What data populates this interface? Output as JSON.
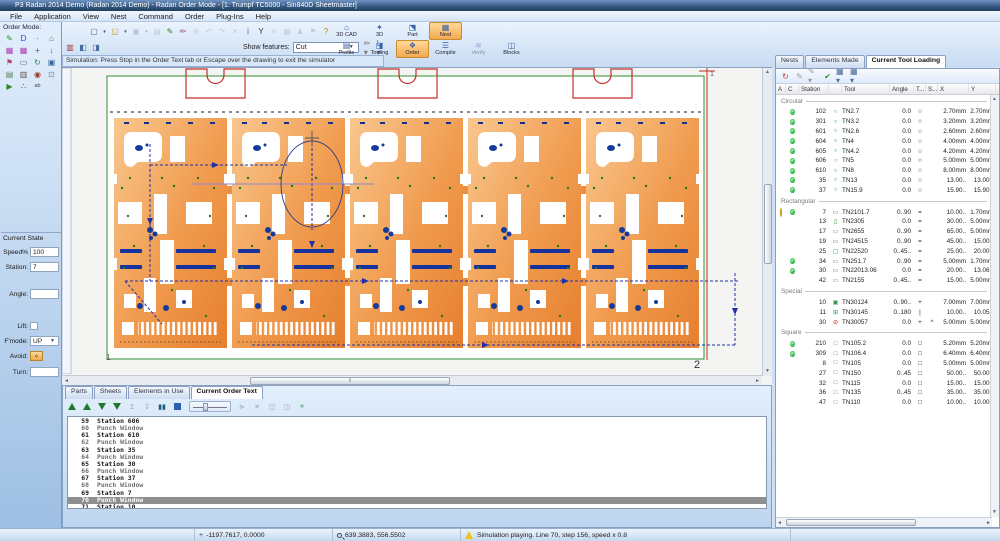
{
  "window": {
    "title": "P3 Radan 2014 Demo (Radan 2014 Demo) - Radan Order Mode - [1: Trumpf TC5000 - Sin840D Sheetmaster]"
  },
  "menus": [
    "File",
    "Application",
    "View",
    "Nest",
    "Command",
    "Order",
    "Plug-Ins",
    "Help"
  ],
  "order_mode_label": "Order Mode:",
  "sidebar_icons": [
    {
      "name": "draw-icon",
      "ch": "✎",
      "c": "#1f8f1f"
    },
    {
      "name": "part-icon",
      "ch": "D",
      "c": "#2050c0"
    },
    {
      "name": "dot-icon",
      "ch": "·",
      "c": "#555"
    },
    {
      "name": "house-icon",
      "ch": "⌂",
      "c": "#8a6a3a"
    },
    {
      "name": "pattern1-icon",
      "ch": "▦",
      "c": "#b03ab0"
    },
    {
      "name": "pattern2-icon",
      "ch": "▦",
      "c": "#b03ab0"
    },
    {
      "name": "move-icon",
      "ch": "+",
      "c": "#2050c0"
    },
    {
      "name": "arrow-down-icon",
      "ch": "↓",
      "c": "#b03ab0"
    },
    {
      "name": "flag-icon",
      "ch": "⚑",
      "c": "#b04060"
    },
    {
      "name": "rect-tool-icon",
      "ch": "▭",
      "c": "#556"
    },
    {
      "name": "rotate-icon",
      "ch": "↻",
      "c": "#2a8a4a"
    },
    {
      "name": "copy-icon",
      "ch": "▣",
      "c": "#35679a"
    },
    {
      "name": "sheet-icon",
      "ch": "▤",
      "c": "#58865a"
    },
    {
      "name": "film-icon",
      "ch": "▥",
      "c": "#665544"
    },
    {
      "name": "target-icon",
      "ch": "◉",
      "c": "#953a2a"
    },
    {
      "name": "disk-icon",
      "ch": "⊡",
      "c": "#789"
    },
    {
      "name": "go-icon",
      "ch": "▶",
      "c": "#2a8a2a"
    },
    {
      "name": "dots-icon",
      "ch": "∴",
      "c": "#444"
    },
    {
      "name": "abc-icon",
      "ch": "ᵃᵇ",
      "c": "#444"
    }
  ],
  "toolbar1_icons": [
    {
      "name": "new-icon",
      "ch": "▢",
      "c": "#4a6a9a"
    },
    {
      "name": "new-dropdown",
      "ch": "▾",
      "c": "#446",
      "drop": true
    },
    {
      "name": "open-icon",
      "ch": "◱",
      "c": "#c79a2a"
    },
    {
      "name": "open-dropdown",
      "ch": "▾",
      "c": "#446",
      "drop": true
    },
    {
      "name": "save-icon",
      "ch": "▣",
      "c": "#6a88b8",
      "dis": true
    },
    {
      "name": "save-dropdown",
      "ch": "▾",
      "c": "#446",
      "drop": true,
      "dis": true
    },
    {
      "name": "print-icon",
      "ch": "▤",
      "c": "#8a95a5",
      "dis": true
    },
    {
      "name": "edit-icon",
      "ch": "✎",
      "c": "#2a7a2a"
    },
    {
      "name": "pen-icon",
      "ch": "✏",
      "c": "#a04a7a"
    },
    {
      "name": "node-icon",
      "ch": "⊕",
      "c": "#9aa",
      "dis": true
    },
    {
      "name": "undo-icon",
      "ch": "↶",
      "c": "#99a",
      "dis": true
    },
    {
      "name": "redo-icon",
      "ch": "↷",
      "c": "#99a",
      "dis": true
    },
    {
      "name": "delete-icon",
      "ch": "✕",
      "c": "#99a",
      "dis": true
    },
    {
      "name": "info-icon",
      "ch": "i",
      "c": "#2a64c8"
    },
    {
      "name": "filter-icon",
      "ch": "Y",
      "c": "#333"
    },
    {
      "name": "list-icon",
      "ch": "≡",
      "c": "#99a",
      "dis": true
    },
    {
      "name": "grid-icon",
      "ch": "▦",
      "c": "#99a",
      "dis": true
    },
    {
      "name": "user-icon",
      "ch": "♟",
      "c": "#99a",
      "dis": true
    },
    {
      "name": "flag2-icon",
      "ch": "⚑",
      "c": "#99a",
      "dis": true
    },
    {
      "name": "help-icon",
      "ch": "?",
      "c": "#b8860b"
    }
  ],
  "toolbar2_icons": [
    {
      "name": "simulate-icon",
      "ch": "▥",
      "c": "#a03a3a"
    },
    {
      "name": "window-left-icon",
      "ch": "◧",
      "c": "#4a6a9a"
    },
    {
      "name": "window-right-icon",
      "ch": "◨",
      "c": "#4a6a9a"
    }
  ],
  "show_features": {
    "label": "Show features:",
    "value": "Cut"
  },
  "toolbar2_right": [
    {
      "name": "pen-dropdown",
      "ch": "✏",
      "c": "#777",
      "drop": true
    },
    {
      "name": "layer-dropdown",
      "ch": "L",
      "c": "#4a6a9a",
      "drop": true
    }
  ],
  "hint": "Simulation: Press Stop in the Order Text tab or Escape over the drawing to exit the simulator",
  "modules": {
    "row1": [
      {
        "label": "3D CAD",
        "icon": "⌂",
        "name": "module-3d-cad"
      },
      {
        "label": "3D",
        "icon": "✦",
        "name": "module-3d"
      },
      {
        "label": "Part",
        "icon": "⬔",
        "name": "module-part"
      },
      {
        "label": "Nest",
        "icon": "▦",
        "name": "module-nest",
        "active": true
      }
    ],
    "row2": [
      {
        "label": "Profile",
        "icon": "▤",
        "name": "module-profile"
      },
      {
        "label": "Tooling",
        "icon": "◨",
        "name": "module-tooling"
      },
      {
        "label": "Order",
        "icon": "❖",
        "name": "module-order",
        "active": true
      },
      {
        "label": "Compile",
        "icon": "☰",
        "name": "module-compile"
      },
      {
        "label": "Verify",
        "icon": "≋",
        "name": "module-verify",
        "dis": true
      },
      {
        "label": "Blocks",
        "icon": "◫",
        "name": "module-blocks"
      }
    ]
  },
  "current_state": {
    "title": "Current State",
    "speed_label": "Speed%",
    "speed": "100",
    "station_label": "Station:",
    "station": "7",
    "angle_label": "Angle:",
    "angle": "",
    "lift_label": "Lift:",
    "fmode_label": "F'mode:",
    "fmode": "UP",
    "avoid_label": "Avoid:",
    "turn_label": "Turn:",
    "turn": ""
  },
  "canvas": {
    "label_left": "1",
    "label_right": "2",
    "label_top_right": "1"
  },
  "right_panel": {
    "tabs": [
      {
        "label": "Nests"
      },
      {
        "label": "Elements Made"
      },
      {
        "label": "Current Tool Loading",
        "active": true
      }
    ],
    "columns": [
      "A",
      "C",
      "Station",
      "Tool",
      "Angle",
      "T...",
      "S...",
      "X",
      "Y"
    ],
    "groups": [
      {
        "name": "Circular",
        "rows": [
          {
            "a": "",
            "c": "check",
            "st": "102",
            "g": "○",
            "gc": "#2f9a3f",
            "tool": "TN2.7",
            "ang": "0.0",
            "t": "○",
            "s": "",
            "x": "2.70mm",
            "y": "2.70mm"
          },
          {
            "a": "",
            "c": "check",
            "st": "301",
            "g": "○",
            "gc": "#2f9a3f",
            "tool": "TN3.2",
            "ang": "0.0",
            "t": "○",
            "s": "",
            "x": "3.20mm",
            "y": "3.20mm"
          },
          {
            "a": "",
            "c": "check",
            "st": "601",
            "g": "○",
            "gc": "#2f9a3f",
            "tool": "TN2.6",
            "ang": "0.0",
            "t": "○",
            "s": "",
            "x": "2.60mm",
            "y": "2.60mm"
          },
          {
            "a": "",
            "c": "check",
            "st": "604",
            "g": "○",
            "gc": "#2f9a3f",
            "tool": "TN4",
            "ang": "0.0",
            "t": "○",
            "s": "",
            "x": "4.00mm",
            "y": "4.00mm"
          },
          {
            "a": "",
            "c": "check",
            "st": "605",
            "g": "○",
            "gc": "#2f9a3f",
            "tool": "TN4.2",
            "ang": "0.0",
            "t": "○",
            "s": "",
            "x": "4.20mm",
            "y": "4.20mm"
          },
          {
            "a": "",
            "c": "check",
            "st": "606",
            "g": "○",
            "gc": "#2f9a3f",
            "tool": "TN5",
            "ang": "0.0",
            "t": "○",
            "s": "",
            "x": "5.00mm",
            "y": "5.00mm"
          },
          {
            "a": "",
            "c": "check",
            "st": "610",
            "g": "○",
            "gc": "#2f9a3f",
            "tool": "TN8",
            "ang": "0.0",
            "t": "○",
            "s": "",
            "x": "8.00mm",
            "y": "8.00mm"
          },
          {
            "a": "",
            "c": "check",
            "st": "35",
            "g": "○",
            "gc": "#2f9a3f",
            "tool": "TN13",
            "ang": "0.0",
            "t": "○",
            "s": "",
            "x": "13.00..",
            "y": "13.00.."
          },
          {
            "a": "",
            "c": "check",
            "st": "37",
            "g": "○",
            "gc": "#2f9a3f",
            "tool": "TN15.9",
            "ang": "0.0",
            "t": "○",
            "s": "",
            "x": "15.90..",
            "y": "15.90.."
          }
        ]
      },
      {
        "name": "Rectangular",
        "rows": [
          {
            "a": "bulb",
            "c": "check",
            "st": "7",
            "g": "▭",
            "gc": "#2f9a3f",
            "tool": "TN2101.7",
            "ang": "0..90",
            "t": "=",
            "s": "",
            "x": "10.00..",
            "y": "1.70mm"
          },
          {
            "a": "",
            "c": "",
            "st": "13",
            "g": "▯",
            "gc": "#2f9a3f",
            "tool": "TN2305",
            "ang": "0.0",
            "t": "=",
            "s": "",
            "x": "30.00..",
            "y": "5.00mm"
          },
          {
            "a": "",
            "c": "",
            "st": "17",
            "g": "▭",
            "gc": "#2f9a3f",
            "tool": "TN2655",
            "ang": "0..90",
            "t": "=",
            "s": "",
            "x": "65.00..",
            "y": "5.00mm"
          },
          {
            "a": "",
            "c": "",
            "st": "19",
            "g": "▭",
            "gc": "#2f9a3f",
            "tool": "TN24515",
            "ang": "0..90",
            "t": "=",
            "s": "",
            "x": "45.00..",
            "y": "15.00.."
          },
          {
            "a": "",
            "c": "",
            "st": "25",
            "g": "▢",
            "gc": "#2f9a3f",
            "tool": "TN22520",
            "ang": "0..45..",
            "t": "=",
            "s": "",
            "x": "25.00..",
            "y": "20.00.."
          },
          {
            "a": "",
            "c": "check",
            "st": "34",
            "g": "▭",
            "gc": "#2f9a3f",
            "tool": "TN251.7",
            "ang": "0..90",
            "t": "=",
            "s": "",
            "x": "5.00mm",
            "y": "1.70mm"
          },
          {
            "a": "",
            "c": "check",
            "st": "30",
            "g": "▭",
            "gc": "#2f9a3f",
            "tool": "TN22013.06",
            "ang": "0.0",
            "t": "=",
            "s": "",
            "x": "20.00..",
            "y": "13.06.."
          },
          {
            "a": "",
            "c": "",
            "st": "42",
            "g": "▭",
            "gc": "#2f9a3f",
            "tool": "TN2155",
            "ang": "0..45..",
            "t": "=",
            "s": "",
            "x": "15.00..",
            "y": "5.00mm"
          }
        ]
      },
      {
        "name": "Special",
        "rows": [
          {
            "a": "",
            "c": "",
            "st": "10",
            "g": "▣",
            "gc": "#2f9a3f",
            "tool": "TN30124",
            "ang": "0..90..",
            "t": "+",
            "s": "",
            "x": "7.00mm",
            "y": "7.00mm"
          },
          {
            "a": "",
            "c": "",
            "st": "11",
            "g": "⊞",
            "gc": "#2f9a3f",
            "tool": "TN30145",
            "ang": "0..180",
            "t": "|",
            "s": "",
            "x": "10.00..",
            "y": "10.05.."
          },
          {
            "a": "",
            "c": "",
            "st": "30",
            "g": "⊘",
            "gc": "#cc2020",
            "tool": "TN30057",
            "ang": "0.0",
            "t": "+",
            "s": "^",
            "x": "5.00mm",
            "y": "5.00mm"
          }
        ]
      },
      {
        "name": "Square",
        "rows": [
          {
            "a": "",
            "c": "check",
            "st": "210",
            "g": "□",
            "gc": "#2f9a3f",
            "tool": "TN105.2",
            "ang": "0.0",
            "t": "□",
            "s": "",
            "x": "5.20mm",
            "y": "5.20mm"
          },
          {
            "a": "",
            "c": "check",
            "st": "309",
            "g": "□",
            "gc": "#2f9a3f",
            "tool": "TN106.4",
            "ang": "0.0",
            "t": "□",
            "s": "",
            "x": "6.40mm",
            "y": "6.40mm"
          },
          {
            "a": "",
            "c": "",
            "st": "8",
            "g": "□",
            "gc": "#2f9a3f",
            "tool": "TN105",
            "ang": "0.0",
            "t": "□",
            "s": "",
            "x": "5.00mm",
            "y": "5.00mm"
          },
          {
            "a": "",
            "c": "",
            "st": "27",
            "g": "□",
            "gc": "#2f9a3f",
            "tool": "TN150",
            "ang": "0..45",
            "t": "□",
            "s": "",
            "x": "50.00..",
            "y": "50.00.."
          },
          {
            "a": "",
            "c": "",
            "st": "32",
            "g": "□",
            "gc": "#2f9a3f",
            "tool": "TN115",
            "ang": "0.0",
            "t": "□",
            "s": "",
            "x": "15.00..",
            "y": "15.00.."
          },
          {
            "a": "",
            "c": "",
            "st": "36",
            "g": "□",
            "gc": "#2f9a3f",
            "tool": "TN135",
            "ang": "0..45",
            "t": "□",
            "s": "",
            "x": "35.00..",
            "y": "35.00.."
          },
          {
            "a": "",
            "c": "",
            "st": "47",
            "g": "□",
            "gc": "#2f9a3f",
            "tool": "TN110",
            "ang": "0.0",
            "t": "□",
            "s": "",
            "x": "10.00..",
            "y": "10.00.."
          }
        ]
      }
    ],
    "toolbar_icons": [
      {
        "name": "refresh-icon",
        "ch": "↻",
        "c": "#c04040"
      },
      {
        "name": "edit-tool-icon",
        "ch": "✎",
        "c": "#9a9a9a"
      },
      {
        "name": "edit-multi-icon",
        "ch": "✎",
        "c": "#9a9a9a",
        "drop": true
      },
      {
        "name": "apply-check-icon",
        "ch": "✔",
        "c": "#2a9a2a"
      },
      {
        "name": "view-grid1-dropdown",
        "ch": "▦",
        "c": "#4a6a9a",
        "drop": true
      },
      {
        "name": "view-grid2-dropdown",
        "ch": "▦",
        "c": "#4a6a9a",
        "drop": true
      }
    ]
  },
  "bottom_panel": {
    "tabs": [
      {
        "label": "Parts"
      },
      {
        "label": "Sheets"
      },
      {
        "label": "Elements in Use"
      },
      {
        "label": "Current Order Text",
        "active": true
      }
    ],
    "toolbar": [
      {
        "name": "run-to-start-button",
        "kind": "tri-up-bar"
      },
      {
        "name": "play-back-button",
        "kind": "tri-up"
      },
      {
        "name": "play-forward-button",
        "kind": "tri-down"
      },
      {
        "name": "run-to-end-button",
        "kind": "tri-down-bar"
      },
      {
        "name": "step-back-button",
        "kind": "txt",
        "ch": "↥",
        "c": "#9aa5b5"
      },
      {
        "name": "step-forward-button",
        "kind": "txt",
        "ch": "↧",
        "c": "#9aa5b5"
      },
      {
        "name": "pause-button",
        "kind": "txt",
        "ch": "▮▮",
        "c": "#1c5f74"
      },
      {
        "name": "stop-button",
        "kind": "stop"
      },
      {
        "name": "speed-slider",
        "kind": "slider"
      },
      {
        "name": "jump-button",
        "kind": "txt",
        "ch": "⊳",
        "c": "#9aa5b5"
      },
      {
        "name": "cut-line-button",
        "kind": "txt",
        "ch": "✕",
        "c": "#9aa5b5"
      },
      {
        "name": "block1-button",
        "kind": "txt",
        "ch": "◫",
        "c": "#9aa5b5"
      },
      {
        "name": "block2-button",
        "kind": "txt",
        "ch": "◫",
        "c": "#9aa5b5"
      },
      {
        "name": "more-button",
        "kind": "txt",
        "ch": "»",
        "c": "#1c7a2d"
      }
    ],
    "lines": [
      {
        "n": "59",
        "text": "Station 606",
        "kind": "station"
      },
      {
        "n": "60",
        "text": "Punch Window",
        "kind": "punch"
      },
      {
        "n": "61",
        "text": "Station 610",
        "kind": "station"
      },
      {
        "n": "62",
        "text": "Punch Window",
        "kind": "punch"
      },
      {
        "n": "63",
        "text": "Station 35",
        "kind": "station"
      },
      {
        "n": "64",
        "text": "Punch Window",
        "kind": "punch"
      },
      {
        "n": "65",
        "text": "Station 30",
        "kind": "station"
      },
      {
        "n": "66",
        "text": "Punch Window",
        "kind": "punch"
      },
      {
        "n": "67",
        "text": "Station 37",
        "kind": "station"
      },
      {
        "n": "68",
        "text": "Punch Window",
        "kind": "punch"
      },
      {
        "n": "69",
        "text": "Station 7",
        "kind": "station"
      },
      {
        "n": "70",
        "text": "Punch Window",
        "kind": "punch",
        "selected": true
      },
      {
        "n": "71",
        "text": "Station 10",
        "kind": "station"
      }
    ]
  },
  "status": {
    "coords1": "-1197.7617, 0.0000",
    "coords2": "639.3883, 556.5502",
    "message": "Simulation playing. Line 70, step 156, speed x 0.8"
  },
  "colors": {
    "accent_orange": "#f5a94f",
    "sheet_orange": "#ee8f3e",
    "sheet_border_green": "#2f8f2f",
    "toolpath_blue": "#2030a8",
    "clamp_red": "#c03028",
    "ok_green": "#2cae43",
    "error_red": "#cc2020",
    "selection_gray": "#8f8f8f"
  }
}
